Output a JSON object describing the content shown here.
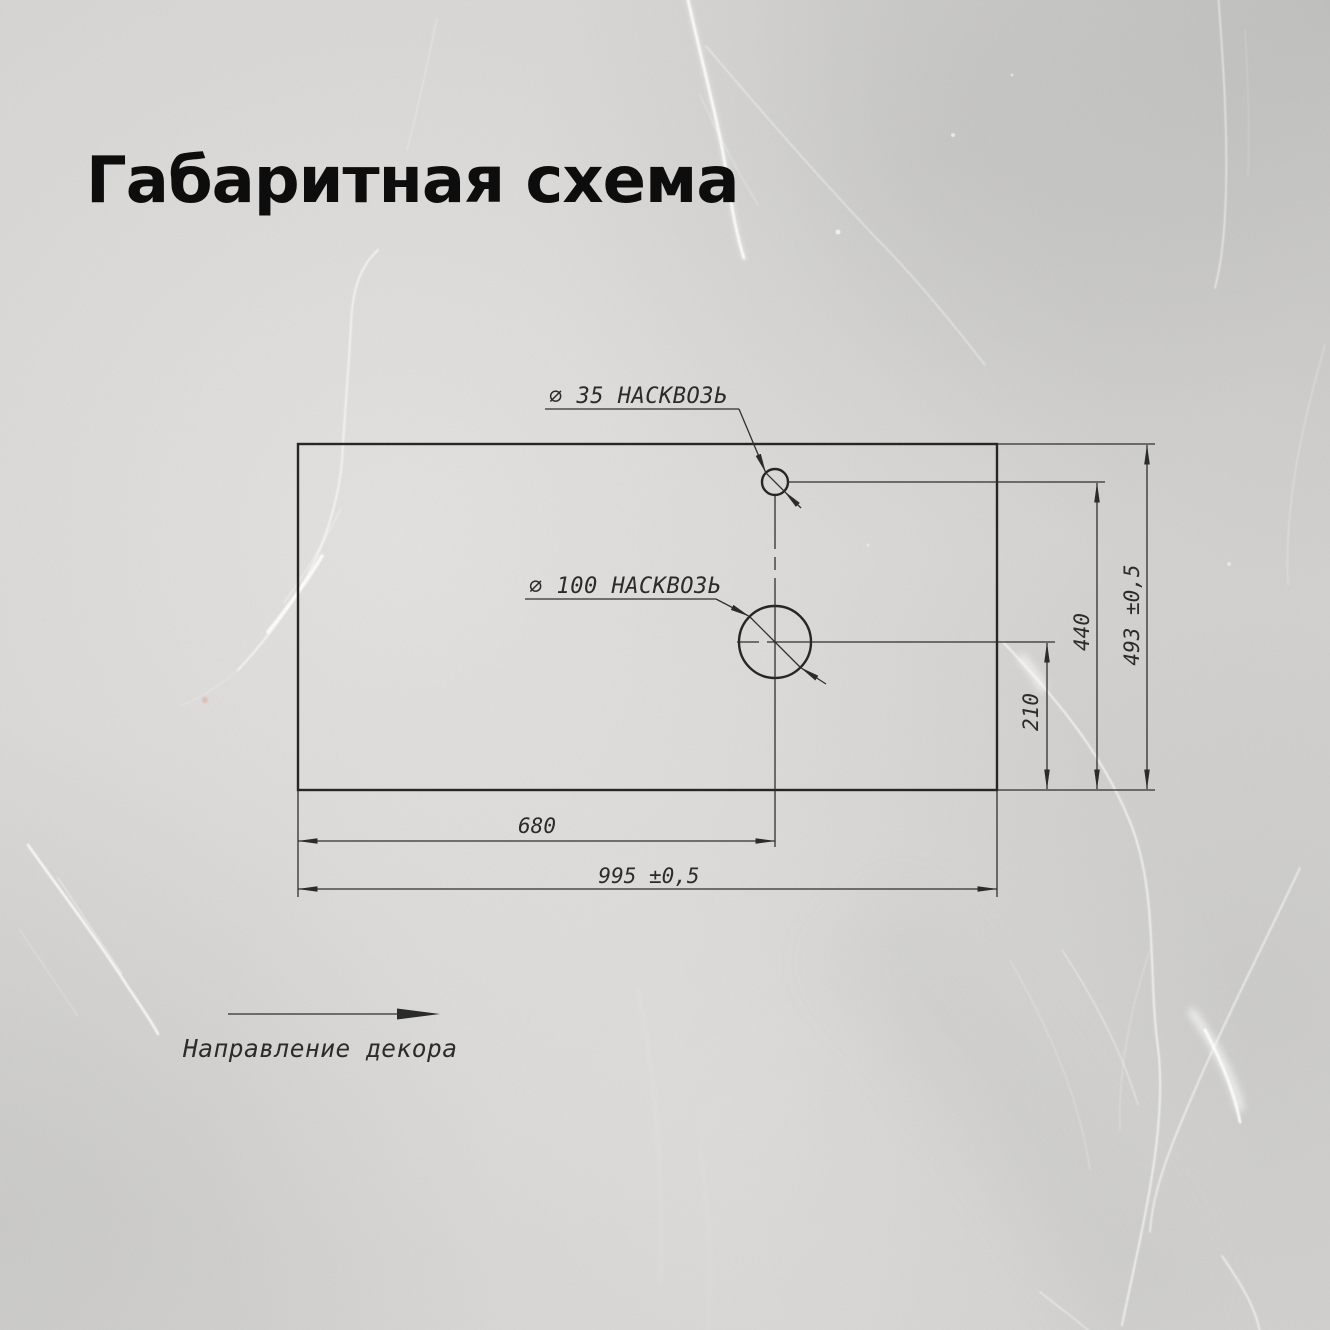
{
  "title": "Габаритная схема",
  "drawing": {
    "hole_small": {
      "label": "⌀ 35 НАСКВОЗЬ"
    },
    "hole_large": {
      "label": "⌀ 100 НАСКВОЗЬ"
    },
    "dims": {
      "width_to_hole_center": "680",
      "width_total": "995 ±0,5",
      "height_to_large_hole": "210",
      "height_to_small_hole": "440",
      "height_total": "493 ±0,5"
    },
    "decor": {
      "label": "Направление декора"
    }
  },
  "colors": {
    "line": "#2f2f2f",
    "title_text": "#0d0d0d",
    "background": "#d4d3d1",
    "vein": "#ffffff"
  }
}
